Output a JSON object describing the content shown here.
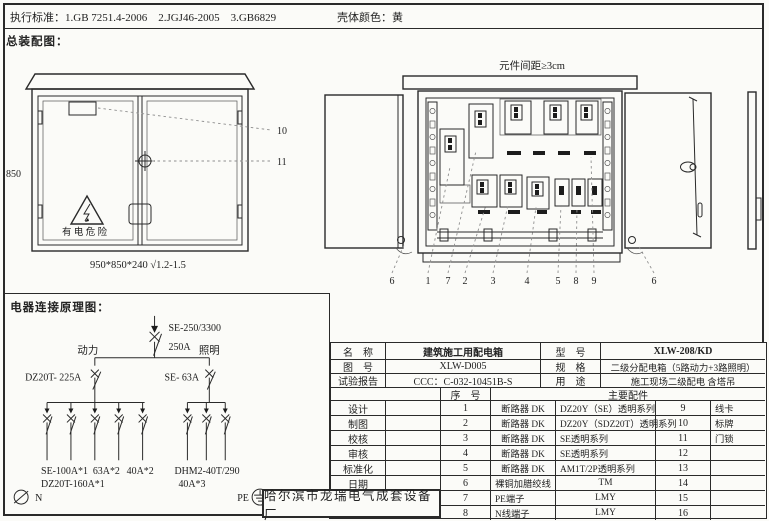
{
  "colors": {
    "ink": "#2a2a2a",
    "paper": "#fbfbf8",
    "leader": "#8f8f8f"
  },
  "header": {
    "standards_label": "执行标准：",
    "standards": "1.GB 7251.4-2006　2.JGJ46-2005　3.GB6829",
    "shell_color_label": "壳体颜色：",
    "shell_color_value": "黄"
  },
  "assembly_view": {
    "title": "总装配图：",
    "height_dim": "850",
    "hazard_text": "有 电 危 险",
    "size_note": "950*850*240 √1.2-1.5",
    "callout_nameplate": "10",
    "callout_handle": "11"
  },
  "internal_view": {
    "spacing_note": "元件间距≥3cm",
    "callouts": [
      "6",
      "1",
      "7",
      "2",
      "3",
      "4",
      "5",
      "8",
      "9",
      "6"
    ]
  },
  "schematic": {
    "title": "电器连接原理图：",
    "main_breaker_model": "SE-250/3300",
    "main_breaker_rating": "250A",
    "power_label": "动力",
    "lighting_label": "照明",
    "power_breaker": "DZ20T- 225A",
    "lighting_breaker": "SE- 63A",
    "power_branches": [
      "SE-100A*1",
      "63A*2",
      "40A*2"
    ],
    "power_branches_line2": "DZ20T-160A*1",
    "lighting_branches": "DHM2-40T/290",
    "lighting_branches_line2": "40A*3",
    "neutral_label": "N",
    "pe_label": "PE"
  },
  "title_block": {
    "name_label": "名　称",
    "name_value": "建筑施工用配电箱",
    "model_label": "型　号",
    "model_value": "XLW-208/KD",
    "drawing_no_label": "图　号",
    "drawing_no_value": "XLW-D005",
    "spec_label": "规　格",
    "spec_value": "二级分配电箱（5路动力+3路照明）",
    "report_label": "试验报告",
    "report_value": "CCC：C-032-10451B-S",
    "use_label": "用　途",
    "use_value": "施工现场二级配电 含塔吊",
    "seq_label": "序　号",
    "parts_label": "主要配件",
    "signoff_rows": [
      "设计",
      "制图",
      "校核",
      "审核",
      "标准化",
      "日期"
    ],
    "company": "哈尔滨市龙瑞电气成套设备厂",
    "parts": [
      {
        "no": "1",
        "name": "断路器 DK",
        "spec": "DZ20Y（SE）透明系列",
        "no2": "9",
        "name2": "线卡"
      },
      {
        "no": "2",
        "name": "断路器 DK",
        "spec": "DZ20Y（SDZ20T）透明系列",
        "no2": "10",
        "name2": "标牌"
      },
      {
        "no": "3",
        "name": "断路器 DK",
        "spec": "SE透明系列",
        "no2": "11",
        "name2": "门锁"
      },
      {
        "no": "4",
        "name": "断路器 DK",
        "spec": "SE透明系列",
        "no2": "12",
        "name2": ""
      },
      {
        "no": "5",
        "name": "断路器 DK",
        "spec": "AM1T/2P透明系列",
        "no2": "13",
        "name2": ""
      },
      {
        "no": "6",
        "name": "裸铜加腊绞线",
        "spec": "TM",
        "no2": "14",
        "name2": ""
      },
      {
        "no": "7",
        "name": "PE端子",
        "spec": "LMY",
        "no2": "15",
        "name2": ""
      },
      {
        "no": "8",
        "name": "N线端子",
        "spec": "LMY",
        "no2": "16",
        "name2": ""
      }
    ]
  }
}
